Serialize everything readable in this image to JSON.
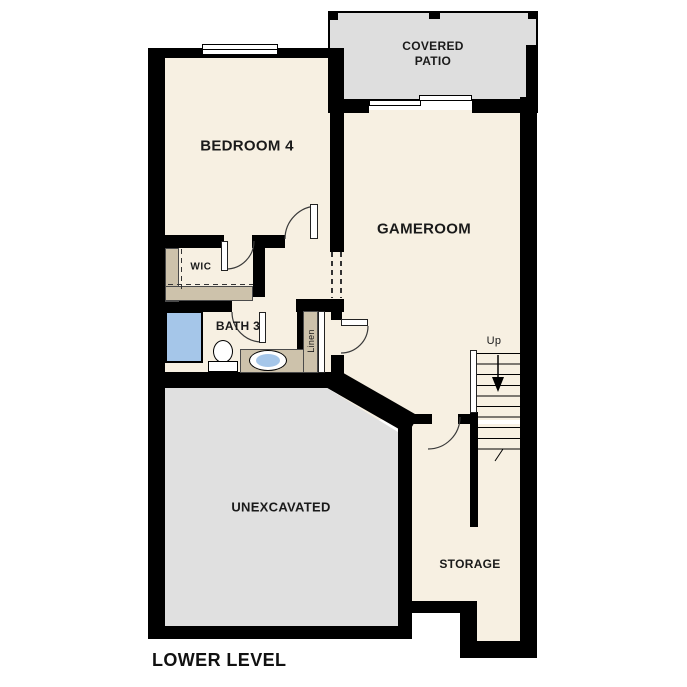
{
  "page_title": "LOWER LEVEL",
  "colors": {
    "wall": "#000000",
    "floor": "#f7f0e2",
    "patio_fill": "#dedede",
    "unexcavated_fill": "#e0e0e0",
    "casework_tan": "#cdc2ab",
    "plumbing_blue": "#a5c6e9"
  },
  "rooms": {
    "covered_patio": {
      "label": "COVERED PATIO"
    },
    "bedroom4": {
      "label": "BEDROOM 4"
    },
    "gameroom": {
      "label": "GAMEROOM"
    },
    "wic": {
      "label": "WIC"
    },
    "bath3": {
      "label": "BATH 3"
    },
    "linen": {
      "label": "Linen"
    },
    "unexcavated": {
      "label": "UNEXCAVATED"
    },
    "storage": {
      "label": "STORAGE"
    }
  },
  "stairs": {
    "up_label": "Up",
    "direction_icon": "down-arrow"
  },
  "fixtures": {
    "shower": "shower-icon",
    "toilet": "toilet-icon",
    "sink": "sink-icon",
    "vanity": "vanity-counter",
    "doors": "door-swing-arc",
    "windows": "window-glyph"
  },
  "footer": {
    "title": "LOWER LEVEL"
  }
}
